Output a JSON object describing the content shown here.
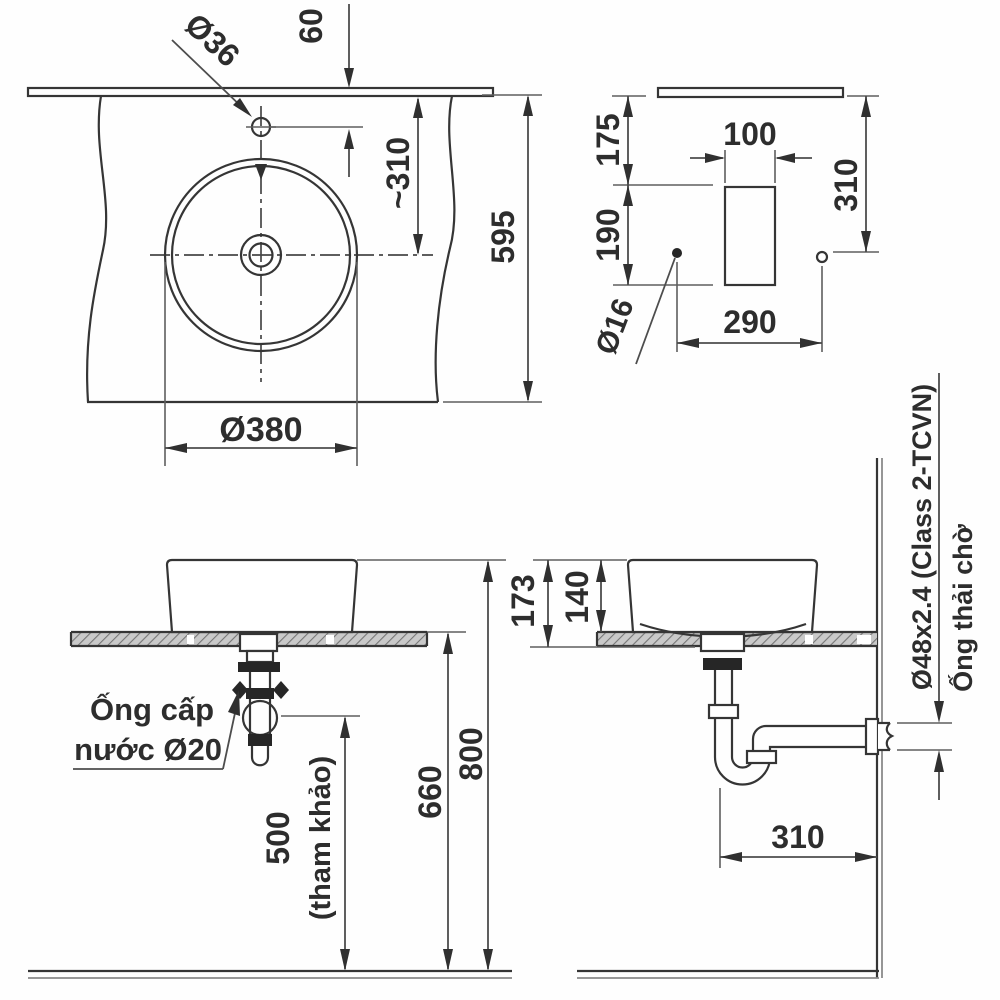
{
  "drawing": {
    "plan": {
      "hole_offset": "60",
      "faucet_hole": "Ø36",
      "center_depth": "~310",
      "counter_depth": "595",
      "bowl_diameter": "Ø380"
    },
    "wall": {
      "seg_top": "175",
      "seg_mid": "190",
      "cutout_width": "100",
      "counter_to_hole": "310",
      "hole_spacing": "290",
      "hole_dia": "Ø16"
    },
    "front": {
      "supply_line1": "Ống cấp",
      "supply_line2": "nước Ø20",
      "supply_height": "500",
      "supply_height_note": "(tham khảo)",
      "counter_height": "660",
      "rim_height": "800"
    },
    "side": {
      "overall_drop": "173",
      "bowl_height": "140",
      "trap_to_wall": "310",
      "waste_pipe_spec": "Ø48x2.4 (Class 2-TCVN)",
      "waste_pipe_label": "Ống thải chờ"
    }
  },
  "colors": {
    "line": "#353535",
    "dim_line": "#4d4d4d",
    "text": "#2d2d2d",
    "hatch": "#777777",
    "hatch_bg": "#c9c9c9",
    "background": "#ffffff"
  }
}
